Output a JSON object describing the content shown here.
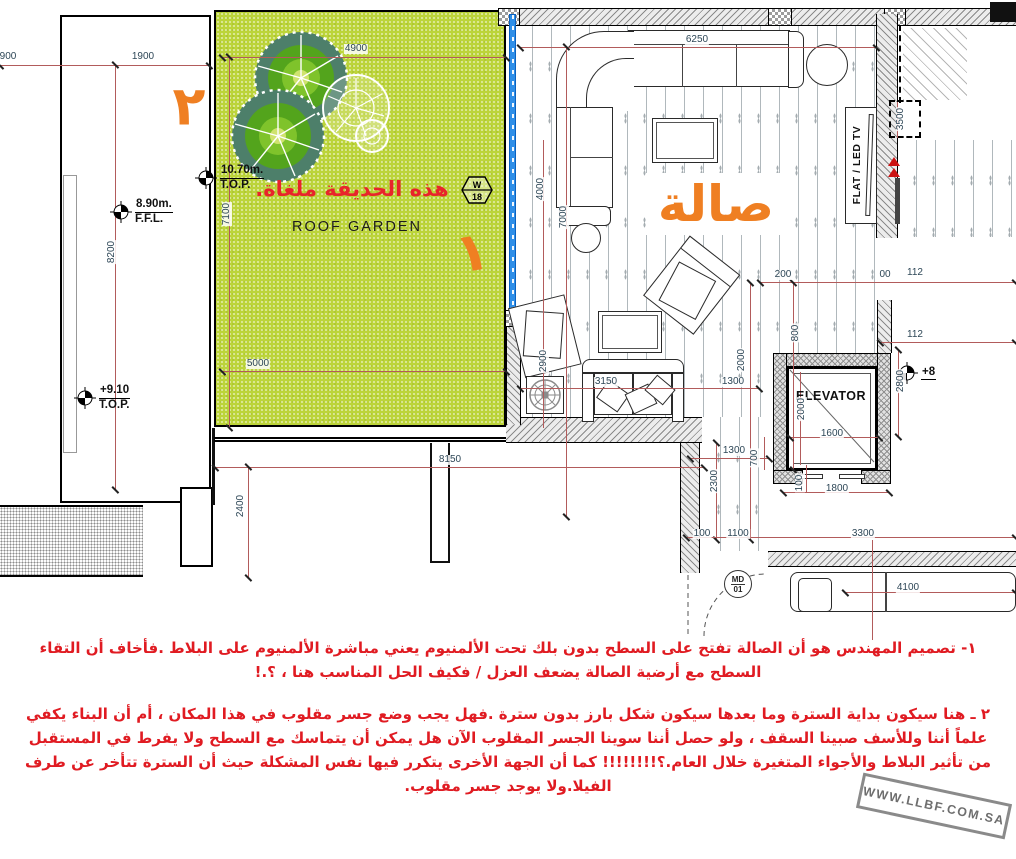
{
  "garden": {
    "cancel_note": "هذه الحديقة ملغاة.",
    "label": "ROOF GARDEN",
    "badge_top": "W",
    "badge_bottom": "18",
    "num_one": "١",
    "num_two": "٢"
  },
  "hall": {
    "title_ar": "صالة",
    "title_en": "MAIN HALL.",
    "tv_label": "FLAT / LED TV"
  },
  "elevator": {
    "label": "ELEVATOR"
  },
  "door_tag": {
    "top": "MD",
    "bottom": "01"
  },
  "levels": [
    {
      "value": "8.90m.",
      "datum": "F.F.L."
    },
    {
      "value": "+9.10",
      "datum": "T.O.P."
    },
    {
      "value": "10.70m.",
      "datum": "T.O.P."
    },
    {
      "value": "+8",
      "datum": ""
    }
  ],
  "dimensions": [
    {
      "t": "900",
      "x": 8,
      "y": 57
    },
    {
      "t": "1900",
      "x": 143,
      "y": 57
    },
    {
      "t": "8200",
      "x": 112,
      "y": 252,
      "r": 1
    },
    {
      "t": "4900",
      "x": 356,
      "y": 49
    },
    {
      "t": "7100",
      "x": 227,
      "y": 214,
      "r": 1
    },
    {
      "t": "5000",
      "x": 258,
      "y": 364
    },
    {
      "t": "6250",
      "x": 697,
      "y": 40
    },
    {
      "t": "4000",
      "x": 541,
      "y": 189,
      "r": 1
    },
    {
      "t": "7000",
      "x": 564,
      "y": 217,
      "r": 1
    },
    {
      "t": "3500",
      "x": 901,
      "y": 119,
      "r": 1
    },
    {
      "t": "200",
      "x": 783,
      "y": 275
    },
    {
      "t": "00",
      "x": 885,
      "y": 275
    },
    {
      "t": "112",
      "x": 915,
      "y": 273
    },
    {
      "t": "112",
      "x": 915,
      "y": 335
    },
    {
      "t": "2800",
      "x": 901,
      "y": 381,
      "r": 1
    },
    {
      "t": "2900",
      "x": 544,
      "y": 361,
      "r": 1
    },
    {
      "t": "2000",
      "x": 742,
      "y": 360,
      "r": 1
    },
    {
      "t": "800",
      "x": 796,
      "y": 333,
      "r": 1
    },
    {
      "t": "3150",
      "x": 606,
      "y": 382
    },
    {
      "t": "1300",
      "x": 733,
      "y": 382
    },
    {
      "t": "2000",
      "x": 802,
      "y": 409,
      "r": 1
    },
    {
      "t": "1600",
      "x": 832,
      "y": 434
    },
    {
      "t": "1300",
      "x": 734,
      "y": 451
    },
    {
      "t": "700",
      "x": 755,
      "y": 458,
      "r": 1
    },
    {
      "t": "2300",
      "x": 715,
      "y": 481,
      "r": 1
    },
    {
      "t": "100",
      "x": 800,
      "y": 483,
      "r": 1
    },
    {
      "t": "1800",
      "x": 837,
      "y": 489
    },
    {
      "t": "2400",
      "x": 241,
      "y": 506,
      "r": 1
    },
    {
      "t": "8150",
      "x": 450,
      "y": 460
    },
    {
      "t": "100",
      "x": 702,
      "y": 534
    },
    {
      "t": "1100",
      "x": 738,
      "y": 534
    },
    {
      "t": "3300",
      "x": 863,
      "y": 534
    },
    {
      "t": "4100",
      "x": 908,
      "y": 588
    }
  ],
  "notes": {
    "para1": "١- تصميم المهندس هو أن الصالة تفتح على السطح بدون بلك تحت الألمنيوم يعني مباشرة الألمنيوم على البلاط .فأخاف أن التقاء السطح مع أرضية الصالة يضعف العزل / فكيف الحل المناسب هنا ، ؟.!",
    "para2": "٢ ـ هنا سيكون بداية السترة وما بعدها سيكون شكل بارز بدون سترة .فهل يجب وضع جسر مقلوب في هذا المكان ، أم أن البناء يكفي علماً أننا وللأسف صبينا السقف ، ولو حصل أننا سوينا الجسر المقلوب الآن هل  يمكن أن يتماسك مع السطح ولا يفرط في المستقبل من تأثير البلاط والأجواء المتغيرة خلال العام.؟!!!!!!!! كما أن الجهة الأخرى يتكرر فيها نفس المشكلة حيث أن السترة تتأخر عن طرف الفيلا.ولا يوجد جسر مقلوب."
  },
  "watermark": "WWW.LLBF.COM.SA",
  "colors": {
    "accent_orange": "#ef7f22",
    "note_red": "#e01b22",
    "garden_green": "#bcd43a",
    "dim_line": "#b25b5b",
    "window_blue": "#2f8fe8"
  }
}
